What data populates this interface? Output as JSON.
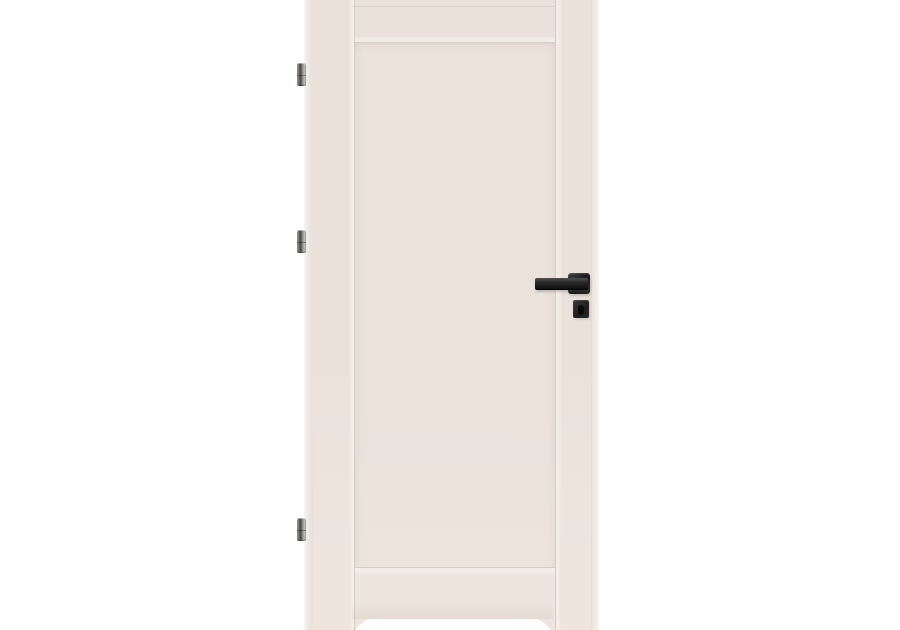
{
  "meta": {
    "description": "Product photograph of a cream-white single-panel interior door leaf on a plain white background; three brushed-steel hinges on the left edge, matte black square-rosette lever handle with separate square key escutcheon near the right edge; door cropped by the image frame at top and bottom with a white floor-reflection notch at the bottom center."
  },
  "theme": {
    "bg": "#ffffff",
    "face": "#e9e1da",
    "face_light": "#ede5de",
    "panel": "#eae2db",
    "groove": "#d5ccc4",
    "bevel_hl": "#f4eee8",
    "edge_hl": "#f9f5f1",
    "faint_line": "#cfc5bd",
    "handle_dark": "#161616",
    "handle_mid": "#2b2b2b",
    "handle_hl": "#505050",
    "keyhole": "#0a0a0a",
    "hinge_light": "#c2beb9",
    "hinge_mid": "#8f8b86",
    "hinge_dark": "#4a4846"
  },
  "scene": {
    "background": "plain white",
    "door": {
      "type": "single flat recessed-panel door leaf",
      "color_name": "cream white",
      "panel_count": 1,
      "crop": "top and bottom edges cut off by image frame"
    },
    "hardware": {
      "hinges": {
        "count": 3,
        "finish": "brushed steel",
        "positions_y": [
          63,
          230,
          518
        ]
      },
      "handle": {
        "type": "square-rosette lever",
        "finish": "matte black",
        "lever_points": "left"
      },
      "escutcheon": {
        "type": "square key rosette",
        "has_keyhole": true,
        "finish": "matte black"
      }
    },
    "floor_highlight": "white reflection notch at bottom center of door"
  }
}
